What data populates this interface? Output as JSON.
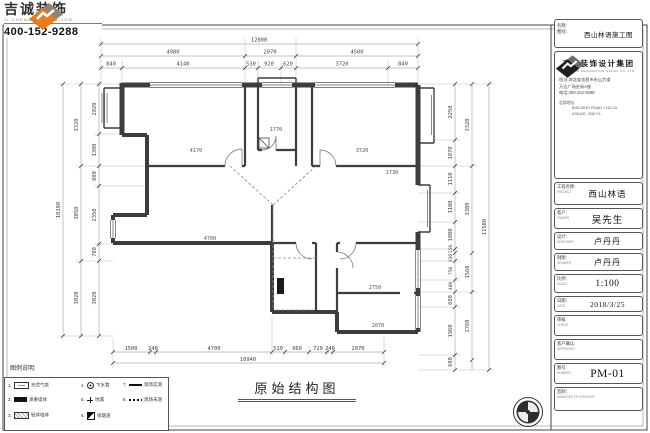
{
  "logo": {
    "brand": "吉诚装饰",
    "brand_en": "JI CHENG DECORATION",
    "phone": "400-152-9288"
  },
  "footer": {
    "drawing_title": "原始结构图"
  },
  "legend": {
    "title": "图例说明:",
    "items": [
      {
        "no": "1.",
        "label": "天然气表"
      },
      {
        "no": "2.",
        "label": "承重墙体"
      },
      {
        "no": "3.",
        "label": "轻体墙体"
      },
      {
        "no": "4.",
        "label": "下水管"
      },
      {
        "no": "5.",
        "label": "地漏"
      },
      {
        "no": "6.",
        "label": "排烟道"
      },
      {
        "no": "7.",
        "label": "现场实测"
      },
      {
        "no": "8.",
        "label": "现场未测"
      }
    ]
  },
  "plan": {
    "dims": {
      "top": {
        "total": "12000",
        "row2": [
          "4980",
          "2070",
          "4500"
        ],
        "row3": [
          "840",
          "4140",
          "530",
          "920",
          "620",
          "3720",
          "840"
        ]
      },
      "left": {
        "total": "10190",
        "mid": [
          "3320",
          "3850",
          "3020"
        ],
        "inner": [
          "2020",
          "1300",
          "800",
          "2350",
          "700",
          "3020"
        ]
      },
      "right": {
        "total": "11580",
        "mid": [
          "3320",
          "3380",
          "1560",
          "2760"
        ],
        "inner": [
          "2250",
          "1070",
          "1110",
          "1180",
          "1080",
          "150",
          "330",
          "750",
          "480",
          "600",
          "1960",
          "600"
        ]
      },
      "bottom": {
        "total": "10940",
        "row1": [
          "1500",
          "240",
          "4700",
          "510",
          "960",
          "720",
          "240",
          "2070"
        ]
      }
    },
    "room_labels": [
      "4170",
      "1770",
      "3720",
      "4700",
      "2750",
      "2070",
      "1730"
    ]
  },
  "titleblock": {
    "name_box": {
      "label1": "名称:",
      "label2": "图别:",
      "value": "西山林语施工图"
    },
    "company": {
      "name": "吉诚装饰设计集团",
      "name_en": "JI CHENG DECORATION GROUP CO.,LTD",
      "addr1": "地址:湖北省宜昌市东山大道",
      "addr2": "万达广场金街A座",
      "tel": "电话:400-152-9288",
      "branch_label": "总部地址:",
      "branch1": "BUILDING ROAD 1 NO.15",
      "branch2": "A BLDG. 2ND FL."
    },
    "rows": [
      {
        "label": "工程名称:",
        "en": "PROJECT",
        "value": "西山林语"
      },
      {
        "label": "客户:",
        "en": "OWNER",
        "value": "吴先生"
      },
      {
        "label": "设计:",
        "en": "DESIGNER",
        "value": "卢丹丹"
      },
      {
        "label": "制图:",
        "en": "DRAWER",
        "value": "卢丹丹"
      },
      {
        "label": "比例:",
        "en": "SCALE",
        "value": "1:100"
      },
      {
        "label": "日期:",
        "en": "DATE",
        "value": "2018/3/25"
      },
      {
        "label": "审核:",
        "en": "CHECK",
        "value": ""
      },
      {
        "label": "客户确认:",
        "en": "APPROVED",
        "value": ""
      },
      {
        "label": "图号:",
        "en": "NUMBER",
        "value": "PM-01"
      },
      {
        "label": "监制:",
        "en": "MANAGER OF INTERIOR",
        "value": ""
      }
    ]
  },
  "colors": {
    "accent_orange": "#e87b1e",
    "logo_gray": "#8d8379",
    "line_dark": "#3d3d3d",
    "dim_gray": "#555555"
  }
}
